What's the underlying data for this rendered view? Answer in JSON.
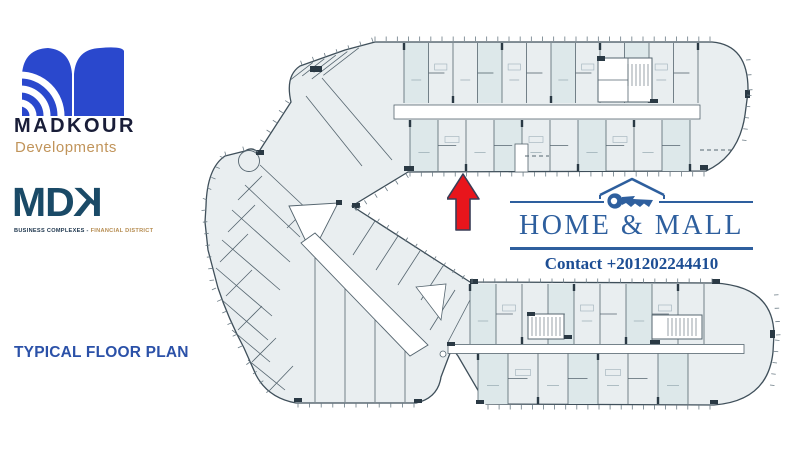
{
  "brand": {
    "madkour": {
      "name": "MADKOUR",
      "subtitle": "Developments",
      "mark_color": "#2a48cd",
      "name_color": "#191d38",
      "subtitle_color": "#c1945a"
    },
    "mdk": {
      "m": "M",
      "d": "D",
      "k": "K",
      "tagline_left": "BUSINESS COMPLEXES",
      "tagline_sep": " - ",
      "tagline_right": "FINANCIAL DISTRICT",
      "text_color": "#1a4a67",
      "tagline_left_color": "#20384f",
      "tagline_right_color": "#b68c50"
    }
  },
  "caption": {
    "text": "TYPICAL FLOOR PLAN",
    "color": "#2b51a8"
  },
  "promo": {
    "title": "HOME & MALL",
    "contact": "Contact +201202244410",
    "accent": "#2e5f9e",
    "contact_color": "#1d4e94"
  },
  "marker": {
    "arrow_fill": "#e8151c",
    "arrow_stroke": "#3a3d56"
  },
  "plan": {
    "fill": "#e9eef0",
    "fill_alt": "#dde8ea",
    "outline": "#3f4f5a",
    "wall": "#55656f",
    "wall_dark": "#2a3944",
    "tick": "#6b7b85",
    "white": "#ffffff"
  }
}
